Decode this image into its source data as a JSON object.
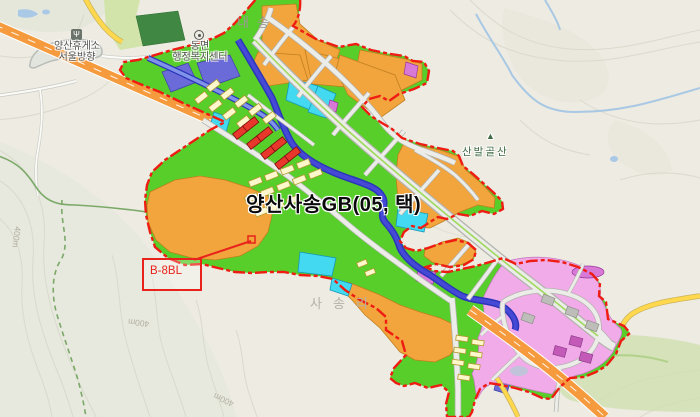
{
  "map": {
    "title": "양산사송GB(05, 택)",
    "callout": {
      "label": "B-8BL"
    },
    "labels": {
      "village_top": "내송",
      "village_bottom": "사송리",
      "mountain": "산발골산",
      "mountain_icon": "▲",
      "office_line1": "동면",
      "office_line2": "행정복지센터",
      "rest_area_line1": "양산휴게소",
      "rest_area_line2": "서울방향",
      "contour": "400m"
    },
    "icons": {
      "rest_area": "Ψ"
    },
    "colors": {
      "boundary": "#ee1c12",
      "park_green": "#57ce2a",
      "parcel_orange": "#f2a43d",
      "parcel_cyan": "#43d9f0",
      "parcel_yellow": "#f4eda8",
      "building_yellow": "#fdf7cc",
      "parcel_red": "#e8382c",
      "parcel_pink": "#f2abe9",
      "parcel_purple": "#6a6ad9",
      "river": "#4549d6",
      "highway": "#f59b3e",
      "road_yellow": "#ffd84e",
      "road_fill": "#ececE8",
      "terrain": "#edebe2"
    }
  }
}
